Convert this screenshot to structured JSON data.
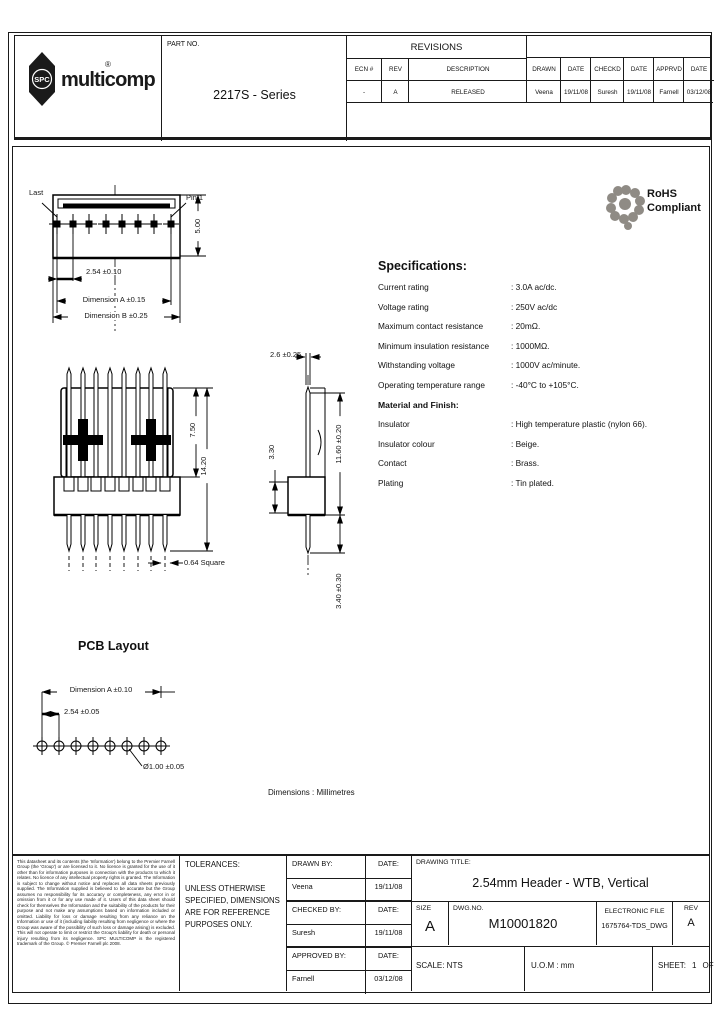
{
  "brand": {
    "name": "multicomp",
    "badge": "SPC",
    "reg": "®"
  },
  "header": {
    "part_no_label": "PART NO.",
    "part_no": "2217S - Series",
    "revisions_title": "REVISIONS",
    "rev_columns": [
      "ECN #",
      "REV",
      "DESCRIPTION",
      "DRAWN",
      "DATE",
      "CHECKD",
      "DATE",
      "APPRVD",
      "DATE"
    ],
    "rev_row": [
      "-",
      "A",
      "RELEASED",
      "Veena",
      "19/11/08",
      "Suresh",
      "19/11/08",
      "Farnell",
      "03/12/08"
    ]
  },
  "rohs": {
    "line1": "RoHS",
    "line2": "Compliant"
  },
  "specs": {
    "title": "Specifications:",
    "rows": [
      {
        "label": "Current rating",
        "value": ": 3.0A ac/dc."
      },
      {
        "label": "Voltage rating",
        "value": ": 250V ac/dc"
      },
      {
        "label": "Maximum contact resistance",
        "value": ": 20mΩ."
      },
      {
        "label": "Minimum insulation resistance",
        "value": ": 1000MΩ."
      },
      {
        "label": "Withstanding voltage",
        "value": ": 1000V ac/minute."
      },
      {
        "label": "Operating temperature range",
        "value": ": -40°C to +105°C."
      }
    ],
    "material_title": "Material and Finish:",
    "material_rows": [
      {
        "label": "Insulator",
        "value": ": High temperature plastic (nylon 66)."
      },
      {
        "label": "Insulator colour",
        "value": ": Beige."
      },
      {
        "label": "Contact",
        "value": ": Brass."
      },
      {
        "label": "Plating",
        "value": ": Tin plated."
      }
    ]
  },
  "views": {
    "pin_count": 8,
    "top": {
      "last": "Last",
      "pin1": "Pin 1",
      "height": "5.00",
      "pitch": "2.54 ±0.10",
      "dim_a": "Dimension A ±0.15",
      "dim_b": "Dimension B ±0.25"
    },
    "front": {
      "upper": "7.50",
      "total": "14.20",
      "pin_sq": "0.64 Square"
    },
    "side": {
      "tail": "2.6 ±0.25",
      "body": "3.30",
      "upper": "11.60 ±0.20",
      "below": "3.40 ±0.30"
    },
    "pcb": {
      "title": "PCB Layout",
      "dim_a": "Dimension A ±0.10",
      "pitch": "2.54 ±0.05",
      "hole": "Ø1.00 ±0.05"
    },
    "units": "Dimensions : Millimetres"
  },
  "footer": {
    "disclaimer": "This datasheet and its contents (the 'Information') belong to the Premier Farnell Group (the 'Group') or are licensed to it. No licence is granted for the use of it other than for information purposes in connection with the products to which it relates. No licence of any intellectual property rights is granted. The Information is subject to change without notice and replaces all data sheets previously supplied. The Information supplied is believed to be accurate but the Group assumes no responsibility for its accuracy or completeness, any error in or omission from it or for any use made of it. Users of this data sheet should check for themselves the Information and the suitability of the products for their purpose and not make any assumptions based on information included or omitted. Liability for loss or damage resulting from any reliance on the Information or use of it (including liability resulting from negligence or where the Group was aware of the possibility of such loss or damage arising) is excluded. This will not operate to limit or restrict the Group's liability for death or personal injury resulting from its negligence. SPC MULTICOMP is the registered trademark of the Group. © Premier Farnell plc 2008.",
    "tolerances_title": "TOLERANCES:",
    "tolerances_body": "UNLESS OTHERWISE SPECIFIED, DIMENSIONS ARE FOR REFERENCE PURPOSES ONLY.",
    "signoff": [
      {
        "role": "DRAWN BY:",
        "date_label": "DATE:",
        "name": "Veena",
        "date": "19/11/08"
      },
      {
        "role": "CHECKED BY:",
        "date_label": "DATE:",
        "name": "Suresh",
        "date": "19/11/08"
      },
      {
        "role": "APPROVED BY:",
        "date_label": "DATE:",
        "name": "Farnell",
        "date": "03/12/08"
      }
    ],
    "title_label": "DRAWING TITLE:",
    "drawing_title": "2.54mm Header - WTB, Vertical",
    "size_label": "SIZE",
    "size": "A",
    "dwg_label": "DWG.NO.",
    "dwg_no": "M10001820",
    "efile_label": "ELECTRONIC FILE",
    "efile": "1675764-TDS_DWG",
    "rev_label": "REV",
    "rev": "A",
    "scale": "SCALE: NTS",
    "uom": "U.O.M : mm",
    "sheet_label": "SHEET:",
    "sheet_no": "1",
    "of_label": "OF",
    "sheet_total": "2"
  }
}
